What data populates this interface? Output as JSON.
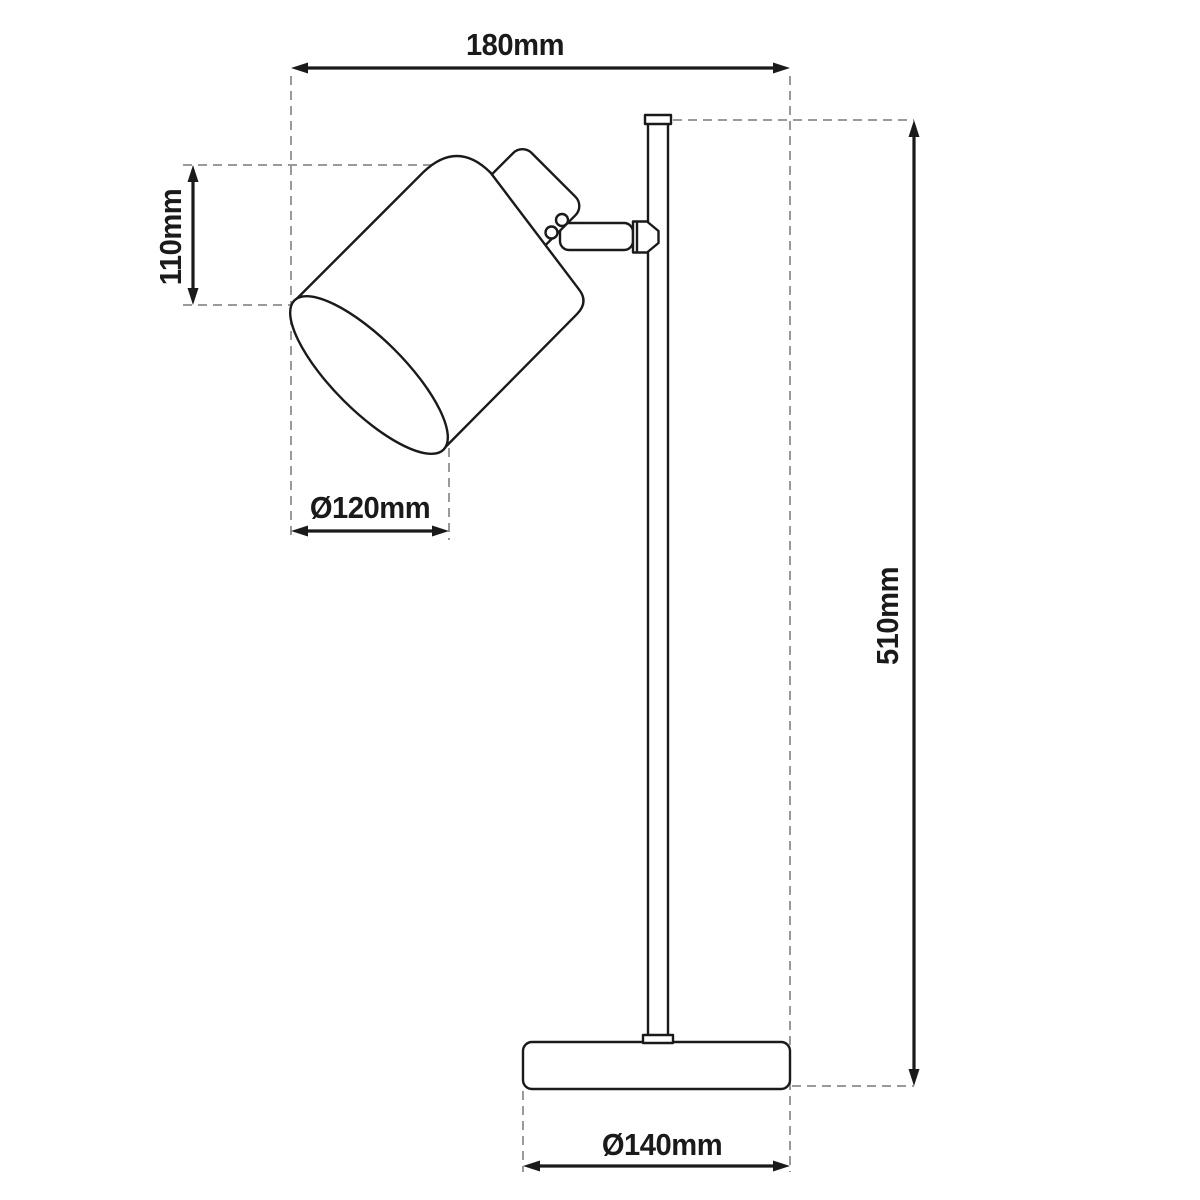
{
  "drawing": {
    "type": "technical-dimension-diagram",
    "subject": "desk lamp side view with spotlight shade, pole and round base",
    "labels": {
      "width_top": "180mm",
      "shade_height": "110mm",
      "shade_diameter": "Ø120mm",
      "total_height": "510mm",
      "base_diameter": "Ø140mm"
    },
    "colors": {
      "line": "#1a1a1a",
      "dashed_line": "#9a9a9a",
      "text": "#1a1a1a",
      "background": "#ffffff"
    }
  }
}
